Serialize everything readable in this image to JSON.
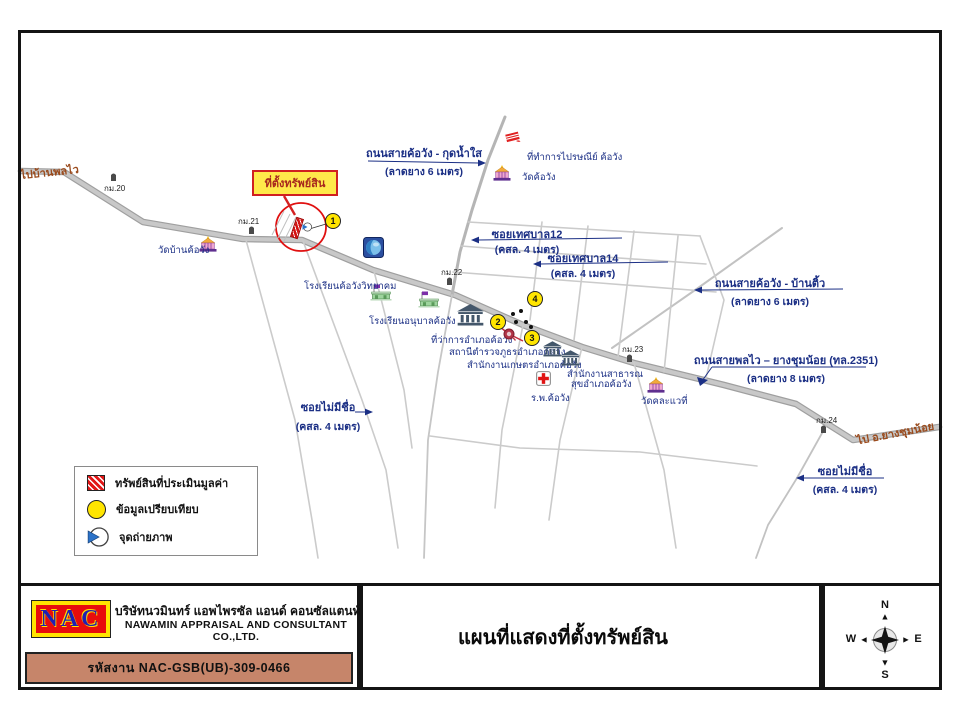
{
  "title_block": {
    "logo_text": "NAC",
    "company_th": "บริษัทนวมินทร์ แอพไพรซัล แอนด์ คอนซัลแตนท์ จำกัด",
    "company_en": "NAWAMIN APPRAISAL AND CONSULTANT CO.,LTD.",
    "job_code": "รหัสงาน  NAC-GSB(UB)-309-0466",
    "map_title": "แผนที่แสดงที่ตั้งทรัพย์สิน",
    "compass": {
      "n": "N",
      "s": "S",
      "e": "E",
      "w": "W"
    }
  },
  "legend": {
    "items": [
      {
        "icon": "property-hatch",
        "label": "ทรัพย์สินที่ประเมินมูลค่า"
      },
      {
        "icon": "comparison-circle",
        "label": "ข้อมูลเปรียบเทียบ"
      },
      {
        "icon": "photo-point",
        "label": "จุดถ่ายภาพ"
      }
    ]
  },
  "colors": {
    "label_navy": "#1b2f85",
    "direction_brown": "#9a4a1c",
    "road_gray": "#9f9f9f",
    "street_gray": "#cbcbcb",
    "marker_yellow": "#ffe500",
    "property_red": "#d81f1f",
    "bar_brown": "#c6856a",
    "logo_red": "#e80c0c",
    "logo_yellow": "#ffe400",
    "logo_blue": "#1f1fb4",
    "photo_blue": "#2b72c8"
  },
  "map": {
    "property": {
      "callout_text": "ที่ตั้งทรัพย์สิน",
      "callout_box": [
        252,
        170,
        86,
        26
      ],
      "bar_center": [
        297,
        228
      ],
      "ellipse": [
        301,
        227,
        25,
        24
      ],
      "pointer": [
        284,
        196,
        295,
        215
      ],
      "leader": [
        326,
        224,
        306,
        230
      ]
    },
    "road_labels": [
      {
        "id": "kudnamsai",
        "text": "ถนนสายค้อวัง - กุดน้ำใส",
        "sub": "(ลาดยาง 6 เมตร)",
        "cx": 424,
        "ty": 144,
        "sy": 163,
        "line": [
          368,
          161,
          479,
          163
        ],
        "arrow": "right"
      },
      {
        "id": "soi-thetsaban-12",
        "text": "ซอยเทศบาล12",
        "sub": "(คสล. 4 เมตร)",
        "cx": 527,
        "ty": 225,
        "sy": 241,
        "line": [
          478,
          240,
          622,
          238
        ],
        "arrow": "left"
      },
      {
        "id": "soi-thetsaban-14",
        "text": "ซอยเทศบาล14",
        "sub": "(คสล. 4 เมตร)",
        "cx": 583,
        "ty": 249,
        "sy": 265,
        "line": [
          540,
          264,
          668,
          262
        ],
        "arrow": "left"
      },
      {
        "id": "bantiu",
        "text": "ถนนสายค้อวัง - บ้านติ้ว",
        "sub": "(ลาดยาง 6 เมตร)",
        "cx": 770,
        "ty": 274,
        "sy": 293,
        "line": [
          701,
          290,
          843,
          289
        ],
        "arrow": "left"
      },
      {
        "id": "highway-2351",
        "text": "ถนนสายพลไว – ยางชุมน้อย (ทล.2351)",
        "sub": "(ลาดยาง 8 เมตร)",
        "cx": 786,
        "ty": 351,
        "sy": 370,
        "line": [
          712,
          367,
          866,
          367
        ],
        "arrow": "down",
        "extra": [
          712,
          367,
          702,
          381
        ]
      },
      {
        "id": "soi-noname-left",
        "text": "ซอยไม่มีชื่อ",
        "sub": "(คสล. 4 เมตร)",
        "cx": 328,
        "ty": 398,
        "sy": 418,
        "line": [
          355,
          412,
          366,
          412
        ],
        "arrow": "right"
      },
      {
        "id": "soi-noname-right",
        "text": "ซอยไม่มีชื่อ",
        "sub": "(คสล. 4 เมตร)",
        "cx": 845,
        "ty": 462,
        "sy": 481,
        "line": [
          803,
          478,
          884,
          478
        ],
        "arrow": "left"
      }
    ],
    "direction_labels": [
      {
        "text": "ไปบ้านพลไว",
        "x": 20,
        "y": 163,
        "rot": -6
      },
      {
        "text": "ไป อ.ยางชุมน้อย",
        "x": 856,
        "y": 424,
        "rot": -11
      }
    ],
    "km_markers": [
      {
        "text": "กม.20",
        "tx": 104,
        "ty": 182,
        "ix": 110,
        "iy": 172
      },
      {
        "text": "กม.21",
        "tx": 238,
        "ty": 215,
        "ix": 248,
        "iy": 225
      },
      {
        "text": "กม.22",
        "tx": 441,
        "ty": 266,
        "ix": 446,
        "iy": 276
      },
      {
        "text": "กม.23",
        "tx": 622,
        "ty": 343,
        "ix": 626,
        "iy": 353
      },
      {
        "text": "กม.24",
        "tx": 816,
        "ty": 414,
        "ix": 820,
        "iy": 424
      }
    ],
    "pois": [
      {
        "icon": "temple",
        "name": "wat-ban-khowang",
        "label": "วัดบ้านค้อวัง",
        "ix": 198,
        "iy": 236,
        "lx": 158,
        "ly": 243
      },
      {
        "icon": "temple",
        "name": "wat-khowang",
        "label": "วัดค้อวัง",
        "ix": 492,
        "iy": 165,
        "lx": 522,
        "ly": 170
      },
      {
        "icon": "post",
        "name": "post-office",
        "label": "ที่ทำการไปรษณีย์ ค้อวัง",
        "ix": 504,
        "iy": 130,
        "lx": 527,
        "ly": 150
      },
      {
        "icon": "school",
        "name": "khowang-wittayakom-school",
        "label": "โรงเรียนค้อวังวิทยาคม",
        "ix": 370,
        "iy": 284,
        "lx": 304,
        "ly": 279
      },
      {
        "icon": "school",
        "name": "anuban-khowang-school",
        "label": "โรงเรียนอนุบาลค้อวัง",
        "ix": 418,
        "iy": 291,
        "lx": 369,
        "ly": 314
      },
      {
        "icon": "bank-lg",
        "name": "district-office",
        "label": "ที่ว่าการอำเภอค้อวัง",
        "ix": 457,
        "iy": 304,
        "lx": 431,
        "ly": 333
      },
      {
        "icon": "police",
        "name": "police-station",
        "label": "สถานีตำรวจภูธรอำเภอค้อวัง",
        "ix": 502,
        "iy": 327,
        "lx": 449,
        "ly": 345
      },
      {
        "icon": "bank",
        "name": "agriculture-office",
        "label": "สำนักงานเกษตรอำเภอค้อวัง",
        "ix": 543,
        "iy": 341,
        "lx": 467,
        "ly": 358
      },
      {
        "icon": "bank",
        "name": "public-health-office",
        "label": "สำนักงานสาธารณ",
        "label2": "สุขอำเภอค้อวัง",
        "ix": 561,
        "iy": 350,
        "lx": 567,
        "ly": 367
      },
      {
        "icon": "hospital",
        "name": "khowang-hospital",
        "label": "ร.พ.ค้อวัง",
        "ix": 536,
        "iy": 371,
        "lx": 531,
        "ly": 391
      },
      {
        "icon": "temple",
        "name": "wat-east",
        "label": "วัดคละแวที่",
        "ix": 646,
        "iy": 377,
        "lx": 641,
        "ly": 394
      },
      {
        "icon": "globe",
        "name": "globe-marker",
        "label": "",
        "ix": 363,
        "iy": 237,
        "lx": 0,
        "ly": 0
      }
    ],
    "comparison_points": [
      {
        "n": "1",
        "x": 333,
        "y": 221
      },
      {
        "n": "2",
        "x": 498,
        "y": 322
      },
      {
        "n": "3",
        "x": 532,
        "y": 338
      },
      {
        "n": "4",
        "x": 535,
        "y": 299
      }
    ],
    "photo_dots": [
      [
        513,
        314
      ],
      [
        521,
        311
      ],
      [
        516,
        322
      ],
      [
        526,
        322
      ],
      [
        531,
        327
      ]
    ],
    "photo_point": {
      "x": 307,
      "y": 227
    }
  }
}
